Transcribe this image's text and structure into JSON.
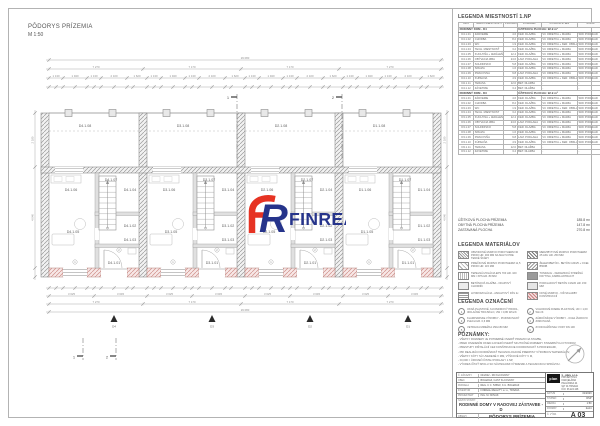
{
  "sheet": {
    "drawing_title_line1": "PÔDORYS PRÍZEMIA",
    "drawing_title_line2": "M 1:50"
  },
  "logo": {
    "text": "FINREAL",
    "red": "#e63323",
    "blue": "#26348b"
  },
  "room_legend": {
    "title": "LEGENDA MIESTNOSTÍ 1.NP",
    "columns": [
      "OZN.",
      "NÁZOV MIESTNOSTI",
      "PLOCHA m²",
      "PODLAHA",
      "POVRCH STIEN",
      "STROP"
    ],
    "groups": [
      {
        "header": "RODINNÝ DOM - D4",
        "header_value": "ÚŽITKOVÁ PLOCHA: 92.9 m²",
        "rows": [
          [
            "D4.1.01",
            "ZÁDVERIE",
            "4.6",
            "KER. DLAŽBA",
            "VC OMIETKA + MAĽBA",
            "SDK PODHĽAD"
          ],
          [
            "D4.1.02",
            "CHODBA",
            "8.2",
            "KER. DLAŽBA",
            "VC OMIETKA + MAĽBA",
            "SDK PODHĽAD"
          ],
          [
            "D4.1.03",
            "WC",
            "1.9",
            "KER. DLAŽBA",
            "VC OMIETKA + KER. OBKLAD",
            "SDK PODHĽAD"
          ],
          [
            "D4.1.04",
            "TECH. MIESTNOSŤ",
            "3.2",
            "KER. DLAŽBA",
            "VC OMIETKA + MAĽBA",
            "SDK PODHĽAD"
          ],
          [
            "D4.1.05",
            "KUCHYŇA + JEDÁLEŇ",
            "12.4",
            "KER. DLAŽBA",
            "VC OMIETKA + MAĽBA",
            "SDK PODHĽAD"
          ],
          [
            "D4.1.06",
            "OBÝVACIA IZBA",
            "24.6",
            "LAM. PODLAHA",
            "VC OMIETKA + MAĽBA",
            "SDK PODHĽAD"
          ],
          [
            "D4.1.07",
            "SCHODISKO",
            "5.8",
            "KER. DLAŽBA",
            "VC OMIETKA + MAĽBA",
            "SDK PODHĽAD"
          ],
          [
            "D4.1.08",
            "ŠPAJZA",
            "1.6",
            "KER. DLAŽBA",
            "VC OMIETKA + MAĽBA",
            "SDK PODHĽAD"
          ],
          [
            "D4.1.09",
            "PRACOVŇA",
            "9.8",
            "LAM. PODLAHA",
            "VC OMIETKA + MAĽBA",
            "SDK PODHĽAD"
          ],
          [
            "D4.1.10",
            "KÚPEĽŇA",
            "4.9",
            "KER. DLAŽBA",
            "VC OMIETKA + KER. OBKLAD",
            "SDK PODHĽAD"
          ],
          [
            "D4.1.11",
            "TERASA",
            "12.0",
            "BET. DLAŽBA",
            "-",
            "-"
          ],
          [
            "D4.1.12",
            "ZÁVETRIE",
            "3.4",
            "BET. DLAŽBA",
            "-",
            "-"
          ]
        ]
      },
      {
        "header": "RODINNÝ DOM - D3",
        "header_value": "ÚŽITKOVÁ PLOCHA: 92.9 m²",
        "rows": [
          [
            "D3.1.01",
            "ZÁDVERIE",
            "4.6",
            "KER. DLAŽBA",
            "VC OMIETKA + MAĽBA",
            "SDK PODHĽAD"
          ],
          [
            "D3.1.02",
            "CHODBA",
            "8.2",
            "KER. DLAŽBA",
            "VC OMIETKA + MAĽBA",
            "SDK PODHĽAD"
          ],
          [
            "D3.1.03",
            "WC",
            "1.9",
            "KER. DLAŽBA",
            "VC OMIETKA + KER. OBKLAD",
            "SDK PODHĽAD"
          ],
          [
            "D3.1.04",
            "TECH. MIESTNOSŤ",
            "3.2",
            "KER. DLAŽBA",
            "VC OMIETKA + MAĽBA",
            "SDK PODHĽAD"
          ],
          [
            "D3.1.05",
            "KUCHYŇA + JEDÁLEŇ",
            "12.4",
            "KER. DLAŽBA",
            "VC OMIETKA + MAĽBA",
            "SDK PODHĽAD"
          ],
          [
            "D3.1.06",
            "OBÝVACIA IZBA",
            "24.6",
            "LAM. PODLAHA",
            "VC OMIETKA + MAĽBA",
            "SDK PODHĽAD"
          ],
          [
            "D3.1.07",
            "SCHODISKO",
            "5.8",
            "KER. DLAŽBA",
            "VC OMIETKA + MAĽBA",
            "SDK PODHĽAD"
          ],
          [
            "D3.1.08",
            "ŠPAJZA",
            "1.6",
            "KER. DLAŽBA",
            "VC OMIETKA + MAĽBA",
            "SDK PODHĽAD"
          ],
          [
            "D3.1.09",
            "PRACOVŇA",
            "9.8",
            "LAM. PODLAHA",
            "VC OMIETKA + MAĽBA",
            "SDK PODHĽAD"
          ],
          [
            "D3.1.10",
            "KÚPEĽŇA",
            "4.9",
            "KER. DLAŽBA",
            "VC OMIETKA + KER. OBKLAD",
            "SDK PODHĽAD"
          ],
          [
            "D3.1.11",
            "TERASA",
            "12.0",
            "BET. DLAŽBA",
            "-",
            "-"
          ],
          [
            "D3.1.12",
            "ZÁVETRIE",
            "3.4",
            "BET. DLAŽBA",
            "-",
            "-"
          ]
        ]
      }
    ]
  },
  "summary": [
    {
      "label": "ÚŽITKOVÁ PLOCHA PRÍZEMIA",
      "value": "185.8 m²"
    },
    {
      "label": "OBYTNÁ PLOCHA PRÍZEMIA",
      "value": "147.8 m²"
    },
    {
      "label": "ZASTAVANÁ PLOCHA",
      "value": "270.8 m²"
    }
  ],
  "materials_legend": {
    "title": "LEGENDA MATERIÁLOV",
    "items": [
      {
        "swatch": "hatch-dense",
        "text": "OBVODOVÉ MURIVO POROTHERM 30 PROFI HR. 300 MM NA MALTU PRE TENKÉ ŠKÁRY"
      },
      {
        "swatch": "hatch-dense2",
        "text": "MEDZIBYTOVÉ MURIVO POROTHERM 25 AKU HR. 250 MM"
      },
      {
        "swatch": "hatch-light",
        "text": "PRIEČKOVÉ MURIVO POROTHERM 11,5 PROFI HR. 115 MM"
      },
      {
        "swatch": "hatch-rc",
        "text": "ŽELEZOBETÓN - BETÓN C20/25 + OCEĽ B500B"
      },
      {
        "swatch": "hatch-ins",
        "text": "TEPELNÁ IZOLÁCIA EPS 70F HR. 100 MM / XPS HR. 80 MM"
      },
      {
        "swatch": "solid",
        "text": "TONDACH - KERAMICKÁ STREŠNÁ KRYTINA, FARBA ANTRACIT"
      },
      {
        "swatch": "plain",
        "text": "BETÓNOVÁ DLAŽBA - OKAPOVÝ CHODNÍK"
      },
      {
        "swatch": "dot",
        "text": "PODKLADOVÝ BETÓN C16/20 HR. 150 MM"
      },
      {
        "swatch": "lines",
        "text": "HYDROIZOLÁCIA - ASFALTOVÝ PÁS 2x"
      },
      {
        "swatch": "red",
        "text": "NOVÉ MURIVO - VIĎ SKLADBY KONŠTRUKCIÍ"
      }
    ]
  },
  "symbols_legend": {
    "title": "LEGENDA OZNAČENÍ",
    "items": [
      {
        "num": "1",
        "text": "OKNÁ PLASTOVÉ, 6-KOMOROVÝ PROFIL, IZOLAČNÉ TROJSKLO, UW = 0,80 W/m²K"
      },
      {
        "num": "2",
        "text": "VCHODOVÉ DVERE PLASTOVÉ, UD = 1,00 W/m²K"
      },
      {
        "num": "3",
        "text": "KLAMPIARSKE VÝROBKY - POZINKOVANÝ PLECH HR. 0,6 MM"
      },
      {
        "num": "4",
        "text": "ZÁMOČNÍCKE VÝROBKY - OCEĽ ŽIAROVO ZINKOVANÁ"
      },
      {
        "num": "5",
        "text": "VETRACIA MRIEŽKA 150x150 MM"
      },
      {
        "num": "6",
        "text": "ZVOD DAŽĎOVEJ VODY DN 100"
      }
    ]
  },
  "notes": {
    "title": "POZNÁMKY:",
    "lines": [
      "- VŠETKY ROZMERY JE POTREBNÉ OVERIŤ PRIAMO NA STAVBE,",
      "- PRED OSADENÍM OKIEN A DVERÍ OVERIŤ SKUTOČNÉ ROZMERY STAVEBNÝCH OTVOROV,",
      "- PRESTUPY INŠTALÁCIÍ CEZ KONŠTRUKCIE KOORDINOVAŤ S PROFESIAMI,",
      "- PRI REALIZÁCII DODRŽIAVAŤ TECHNOLOGICKÉ PREDPISY VÝROBCOV MATERIÁLOV,",
      "- VŠETKY KÓTY SÚ UVEDENÉ V MM, VÝŠKOVÉ KÓTY V M,",
      "- ±0,000 = ÚROVEŇ ČISTEJ PODLAHY 1.NP,",
      "- VÝKRES ČÍTAŤ SPOLU SO SÚVISIACIMI VÝKRESMI A TECHNICKOU SPRÁVOU."
    ]
  },
  "title_block": {
    "info_rows": [
      {
        "label": "Č. ZÁKAZKY",
        "value": "04/2022 - RD KLČOVANY"
      },
      {
        "label": "OBEC",
        "value": "BOLERÁZ, ČASŤ KLČOVANY"
      },
      {
        "label": "PARCELA",
        "value": "REG. C Č. 5358/2, K.Ú. BOLERÁZ"
      },
      {
        "label": "INVESTOR",
        "value": "FINREAL REALITY s.r.o., TRNAVA"
      },
      {
        "label": "PROJEKTANT",
        "value": "ING. M. NOVÁK"
      }
    ],
    "project_label": "NÁZOV STAVBY:",
    "project_name": "RODINNÉ DOMY V RADOVEJ ZÁSTAVBE - D",
    "content_label": "OBSAH:",
    "content_value": "PÔDORYS PRÍZEMIA",
    "stamp": {
      "mark": "plan",
      "firm": "š - plan, s.r.o.",
      "lines": [
        "PROJEKTOVÁ KANCELÁRIA",
        "PAULÍNSKA 24",
        "917 01 TRNAVA",
        "IČO: 36 224 448"
      ]
    },
    "meta_rows": [
      {
        "label": "DÁTUM",
        "value": "01/2023"
      },
      {
        "label": "STUPEŇ",
        "value": "DSP"
      },
      {
        "label": "MIERKA",
        "value": "1:50"
      },
      {
        "label": "FORMÁT",
        "value": "2xA4"
      }
    ],
    "number_label": "Č. VÝKR.",
    "number_value": "A 03"
  },
  "plan": {
    "units": [
      {
        "code": "D4"
      },
      {
        "code": "D3"
      },
      {
        "code": "D2"
      },
      {
        "code": "D1"
      }
    ],
    "room_suffixes": [
      "1.08",
      "1.07",
      "1.06",
      "1.04",
      "1.05",
      "1.02",
      "1.03",
      "1.01"
    ],
    "dims": {
      "overall": "29 080",
      "units": [
        "7 270",
        "7 170",
        "7 170",
        "7 270"
      ],
      "unit_parts": [
        "1 130",
        "1 940",
        "1 130",
        "2 100",
        "1 620"
      ],
      "unit_halves": [
        "3 625",
        "3 645"
      ],
      "left": [
        "2 180",
        "4 040"
      ],
      "right": [
        "2 180",
        "4 040"
      ]
    },
    "section_marks_top": [
      "1",
      "2"
    ],
    "section_marks_bottom": [
      "1",
      "2"
    ],
    "entrance_labels": [
      "D4",
      "D3",
      "D2",
      "D1"
    ]
  }
}
